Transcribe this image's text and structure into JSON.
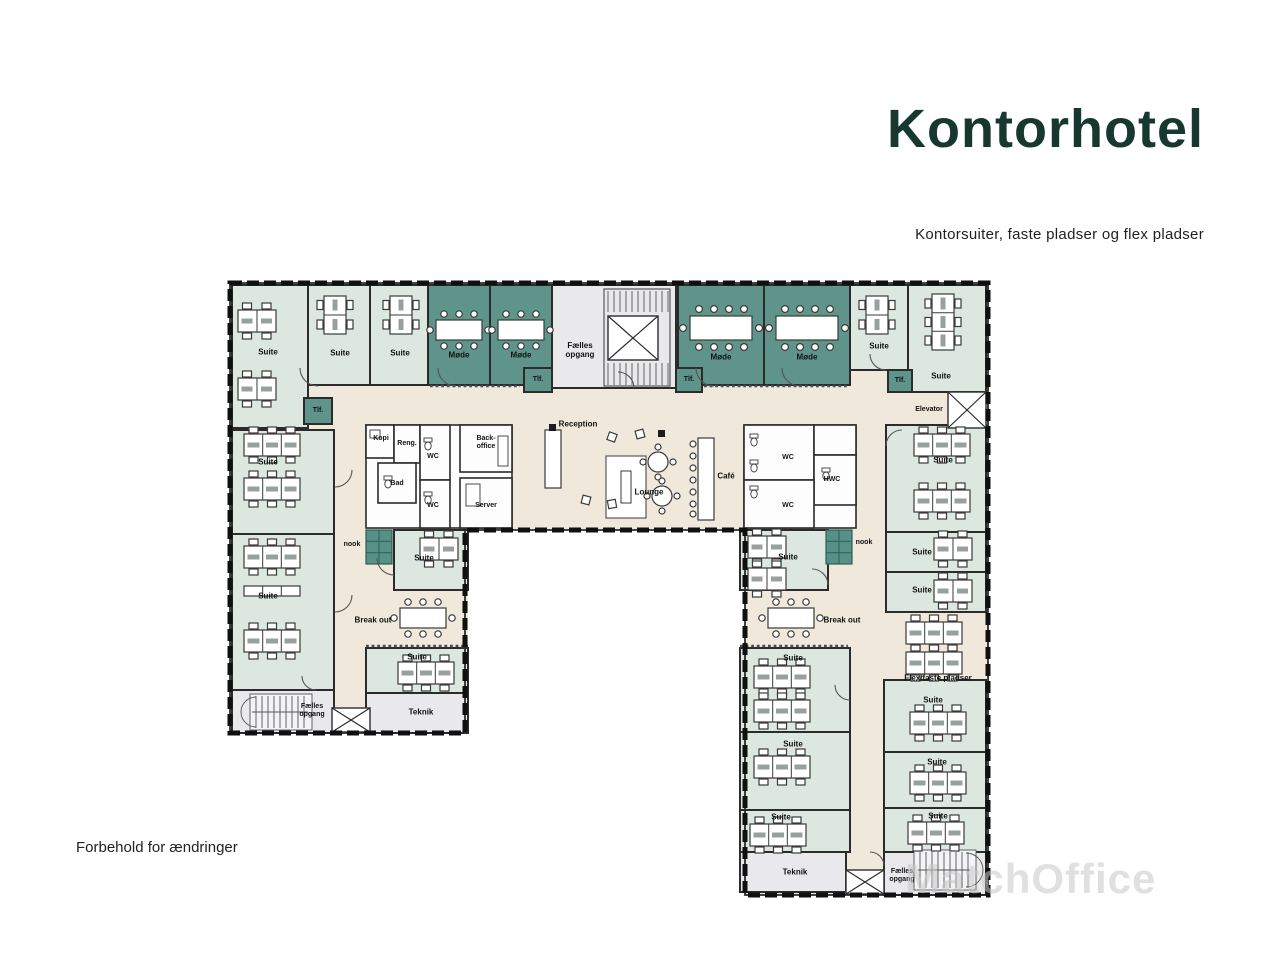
{
  "header": {
    "title": "Kontorhotel",
    "subtitle": "Kontorsuiter, faste pladser og flex pladser"
  },
  "notes": {
    "disclaimer": "Forbehold for ændringer",
    "watermark": "MatchOffice"
  },
  "palette": {
    "suite_green": "#dbe7df",
    "meeting_teal": "#5f948a",
    "service_gray": "#e9e9ec",
    "corridor_tan": "#f0e8da",
    "title_green": "#17382e"
  },
  "plan": {
    "rooms": [
      {
        "id": "suite-top-left",
        "label": "Suite"
      },
      {
        "id": "tlf-top-left",
        "label": "Tlf."
      },
      {
        "id": "suite-top-2",
        "label": "Suite"
      },
      {
        "id": "suite-top-3",
        "label": "Suite"
      },
      {
        "id": "mode-1",
        "label": "Møde"
      },
      {
        "id": "mode-2",
        "label": "Møde"
      },
      {
        "id": "stairwell-top",
        "label": "Fælles opgang"
      },
      {
        "id": "tlf-stair-left",
        "label": "Tlf."
      },
      {
        "id": "tlf-stair-right",
        "label": "Tlf."
      },
      {
        "id": "mode-3",
        "label": "Møde"
      },
      {
        "id": "mode-4",
        "label": "Møde"
      },
      {
        "id": "suite-top-4",
        "label": "Suite"
      },
      {
        "id": "tlf-top-right",
        "label": "Tlf."
      },
      {
        "id": "suite-top-5",
        "label": "Suite"
      },
      {
        "id": "elevator",
        "label": "Elevator"
      },
      {
        "id": "suite-west-1",
        "label": "Suite"
      },
      {
        "id": "suite-west-2",
        "label": "Suite"
      },
      {
        "id": "stairwell-southwest",
        "label": "Fælles opgang"
      },
      {
        "id": "kopi",
        "label": "Kopi"
      },
      {
        "id": "reng",
        "label": "Reng."
      },
      {
        "id": "wc-west-1",
        "label": "WC"
      },
      {
        "id": "bad",
        "label": "Bad"
      },
      {
        "id": "wc-west-2",
        "label": "WC"
      },
      {
        "id": "back-office",
        "label": "Back-office"
      },
      {
        "id": "server",
        "label": "Server"
      },
      {
        "id": "reception",
        "label": "Reception"
      },
      {
        "id": "lounge",
        "label": "Lounge"
      },
      {
        "id": "cafe",
        "label": "Café"
      },
      {
        "id": "wc-east-1",
        "label": "WC"
      },
      {
        "id": "hwc",
        "label": "HWC"
      },
      {
        "id": "wc-east-2",
        "label": "WC"
      },
      {
        "id": "nook-west",
        "label": "nook"
      },
      {
        "id": "suite-west-leg-1",
        "label": "Suite"
      },
      {
        "id": "breakout-west",
        "label": "Break out"
      },
      {
        "id": "suite-west-leg-2",
        "label": "Suite"
      },
      {
        "id": "teknik-west",
        "label": "Teknik"
      },
      {
        "id": "nook-east",
        "label": "nook"
      },
      {
        "id": "suite-east-leg-1",
        "label": "Suite"
      },
      {
        "id": "breakout-east",
        "label": "Break out"
      },
      {
        "id": "suite-east-leg-2",
        "label": "Suite"
      },
      {
        "id": "suite-east-1",
        "label": "Suite"
      },
      {
        "id": "suite-east-2",
        "label": "Suite"
      },
      {
        "id": "suite-east-3",
        "label": "Suite"
      },
      {
        "id": "flex-pladser",
        "label": "Flex/faste pladser"
      },
      {
        "id": "suite-east-leg-3",
        "label": "Suite"
      },
      {
        "id": "suite-east-leg-4",
        "label": "Suite"
      },
      {
        "id": "teknik-east",
        "label": "Teknik"
      },
      {
        "id": "suite-east-4",
        "label": "Suite"
      },
      {
        "id": "suite-east-5",
        "label": "Suite"
      },
      {
        "id": "suite-east-6",
        "label": "Suite"
      },
      {
        "id": "stairwell-southeast",
        "label": "Fælles opgang"
      }
    ]
  }
}
